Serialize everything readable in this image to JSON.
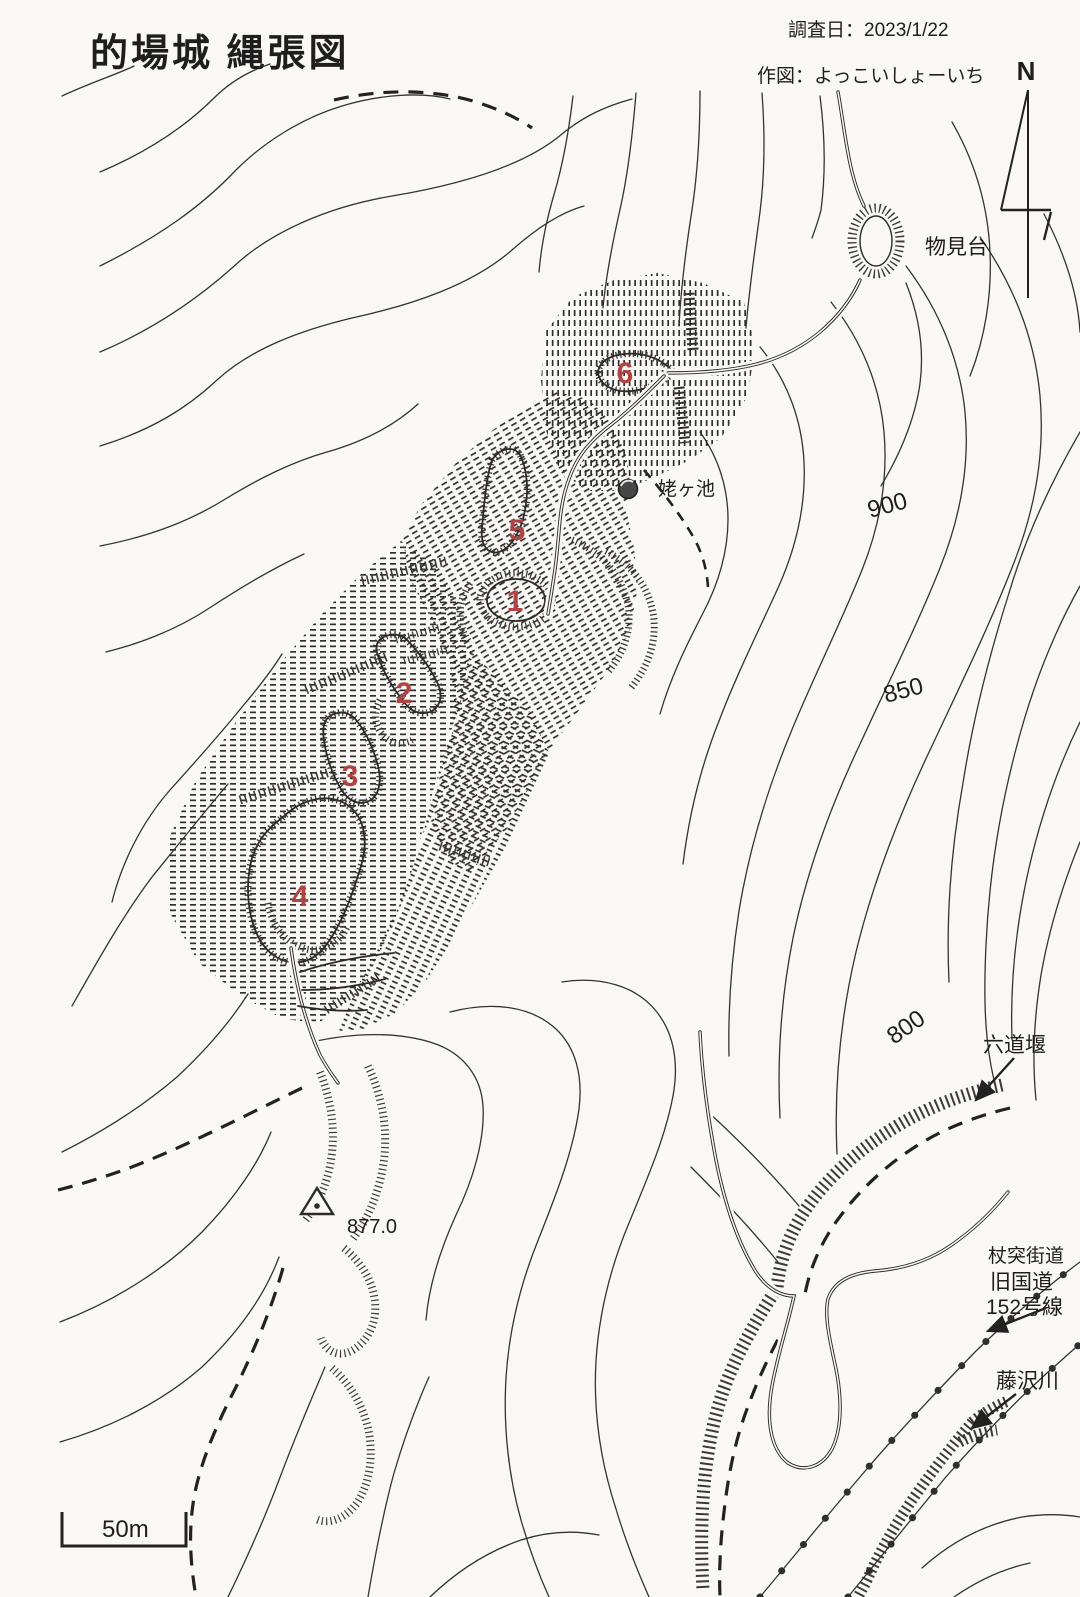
{
  "title": "的場城 縄張図",
  "meta": {
    "survey_date": "調査日：2023/1/22",
    "author": "作図：よっこいしょーいち"
  },
  "compass": {
    "north_label": "N"
  },
  "scale_bar": {
    "label": "50m"
  },
  "contour_labels": {
    "c900": "900",
    "c850": "850",
    "c800": "800"
  },
  "enclosures": {
    "n1": "1",
    "n2": "2",
    "n3": "3",
    "n4": "4",
    "n5": "5",
    "n6": "6"
  },
  "landmarks": {
    "watchtower": "物見台",
    "pond": "姥ヶ池",
    "weir": "六道堰",
    "road_name": "杖突街道",
    "road_type": "旧国道",
    "road_number": "152号線",
    "river": "藤沢川",
    "summit_elevation": "877.0"
  },
  "colors": {
    "ink": "#2b2b2b",
    "number_red": "#b04343",
    "paper": "#f9f8f4"
  }
}
